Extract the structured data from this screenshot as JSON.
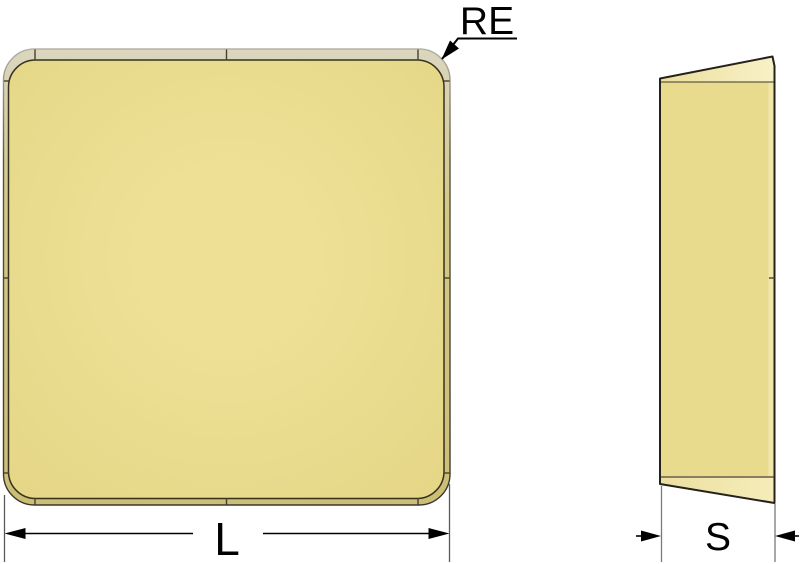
{
  "drawing": {
    "labels": {
      "corner_radius": "RE",
      "length": "L",
      "thickness": "S"
    },
    "colors": {
      "insert_face": "#e8db8e",
      "face_center": "#eee196",
      "rim_light": "#dad6c0",
      "rim_mid": "#d5c988",
      "rim_dark": "#cdbe76",
      "bevel_highlight": "#f8f1c8",
      "bevel_base": "#ecdf9c",
      "outline": "#2f2c22",
      "seam_line": "#45412f",
      "bottom_edge_line": "#8b7d5e",
      "dimension_line": "#000000",
      "extension_line": "#6f6f6f",
      "background": "#ffffff"
    }
  }
}
